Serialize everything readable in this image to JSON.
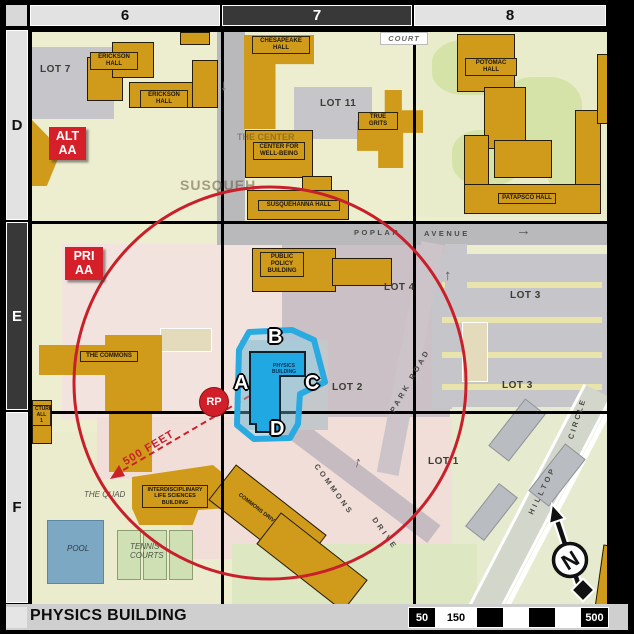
{
  "header": {
    "col6": "6",
    "col7": "7",
    "col8": "8",
    "rowD": "D",
    "rowE": "E",
    "rowF": "F"
  },
  "footer": {
    "title": "PHYSICS BUILDING",
    "scale": {
      "s50": "50",
      "s150": "150",
      "s500": "500"
    }
  },
  "markers": {
    "alt_stop": "ALT\nAA",
    "pri_stop": "PRI\nAA",
    "rp": "RP",
    "radius_label": "500 FEET",
    "entrance_a": "A",
    "entrance_b": "B",
    "entrance_c": "C",
    "entrance_d": "D",
    "compass_n": "N"
  },
  "buildings": {
    "erickson_upper": "ERICKSON HALL",
    "erickson_lower": "ERICKSON HALL",
    "chesapeake": "CHESAPEAKE HALL",
    "center_well_being": "CENTER FOR WELL-BEING",
    "susquehanna": "SUSQUEHANNA HALL",
    "true_grits": "TRUE GRITS",
    "potomac": "POTOMAC HALL",
    "patapsco": "PATAPSCO HALL",
    "public_policy": "PUBLIC POLICY BUILDING",
    "the_commons": "THE COMMONS",
    "physics": "PHYSICS\nBUILDING",
    "ilsb": "INTERDISCIPLINARY LIFE SCIENCES BUILDING",
    "garage": "COMMONS DRIVE GARAGE",
    "lecture_edge": "CTURE\nALL 1"
  },
  "lots": {
    "lot7": "LOT 7",
    "lot11": "LOT 11",
    "lot4": "LOT 4",
    "lot3_upper": "LOT 3",
    "lot3_lower": "LOT 3",
    "lot2": "LOT 2",
    "lot1": "LOT 1"
  },
  "streets": {
    "poplar": "POPLAR",
    "avenue": "AVENUE",
    "court": "COURT",
    "park_road": "PARK ROAD",
    "commons": "COMMONS",
    "drive": "DRIVE",
    "hilltop": "HILLTOP",
    "circle": "CIRCLE",
    "arrow_right": "→",
    "arrow_down": "↓",
    "arrow_up": "↑"
  },
  "places": {
    "quad": "THE QUAD",
    "pool": "POOL",
    "tennis": "TENNIS COURTS"
  },
  "faded": {
    "susqueh": "SUSQUEH",
    "the_center": "THE CENTER"
  },
  "colors": {
    "accent_red": "#c8202a",
    "highlight_cyan": "#29abe2",
    "building_gold": "#d09b1a",
    "physics_blue": "#1fa8e2"
  }
}
